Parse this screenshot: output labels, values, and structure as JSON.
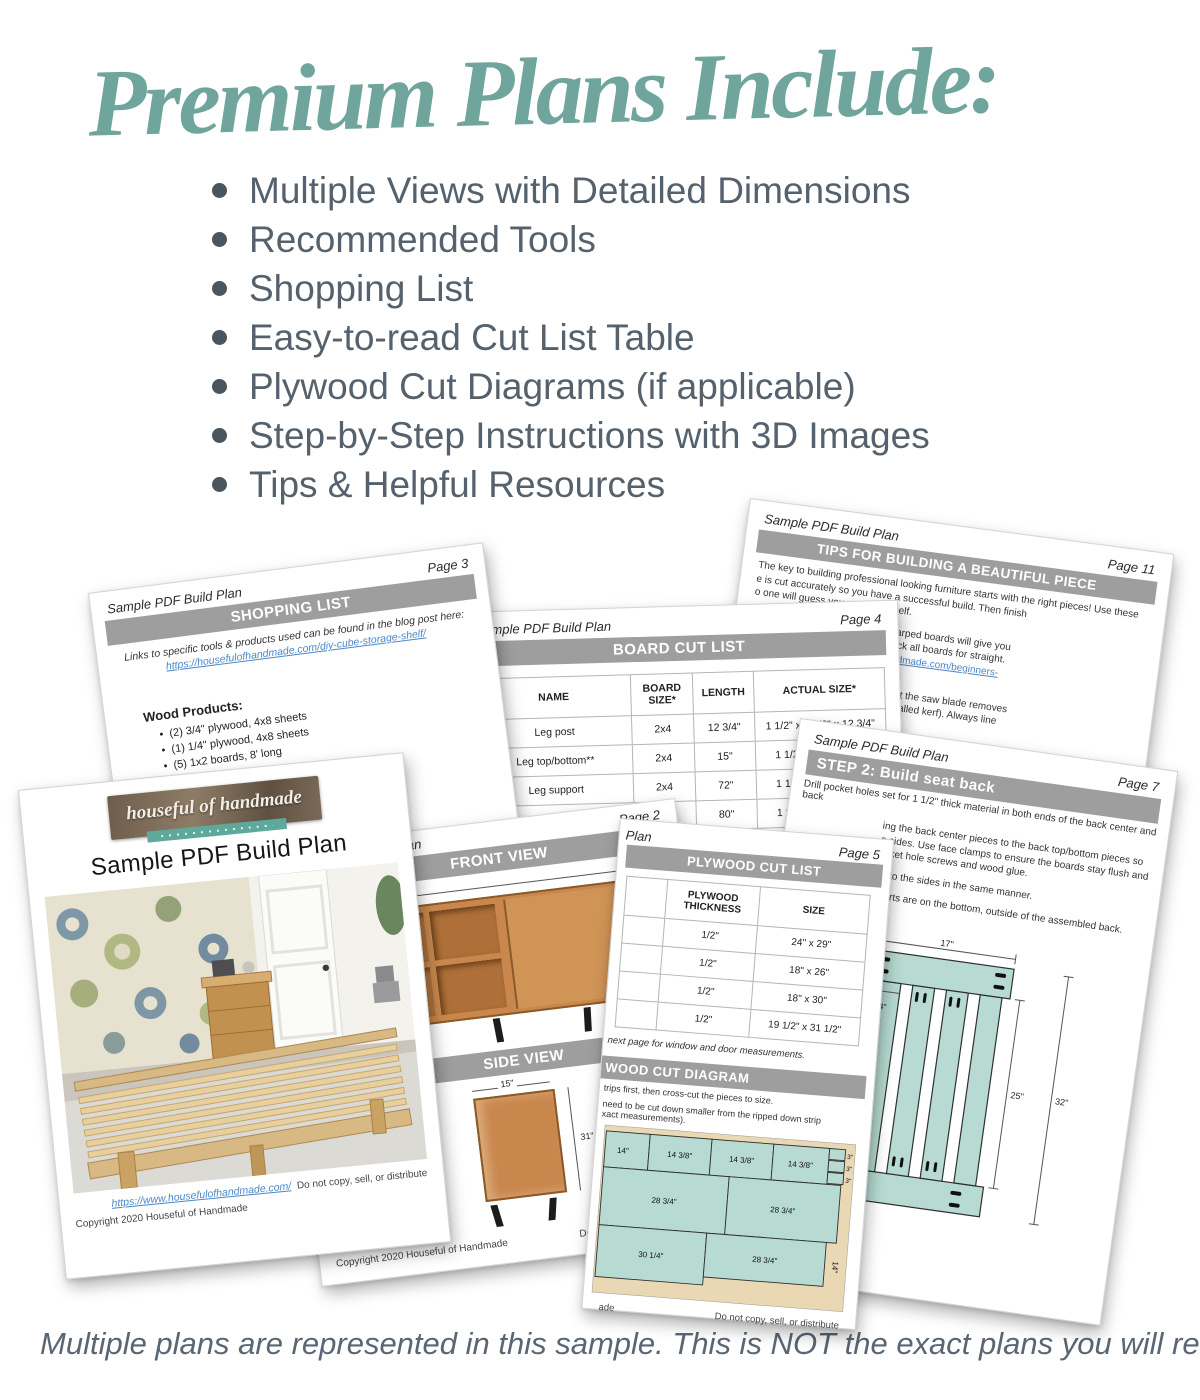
{
  "headline": {
    "title": "Premium Plans Include:"
  },
  "bullets": [
    "Multiple Views with Detailed Dimensions",
    "Recommended Tools",
    "Shopping List",
    "Easy-to-read Cut List Table",
    "Plywood Cut Diagrams (if applicable)",
    "Step-by-Step Instructions with 3D Images",
    "Tips & Helpful Resources"
  ],
  "footer_note": "Multiple plans are represented in this sample. This is NOT the exact plans you will recieve.",
  "colors": {
    "accent_teal": "#6FA59D",
    "banner_gray": "#9E9E9E",
    "link_blue": "#4A87C7",
    "teal_piece": "#B7DBD2",
    "plywood_tan": "#EAD8B4"
  },
  "pages": {
    "cover": {
      "logo_text": "houseful of handmade",
      "doc_title": "Sample PDF Build Plan",
      "footer_link": "https://www.housefulofhandmade.com/",
      "footer_right": "Do not copy, sell, or distribute",
      "footer_copyright": "Copyright 2020 Houseful of Handmade"
    },
    "shopping": {
      "header": "Sample PDF Build Plan",
      "page_label": "Page 3",
      "banner": "SHOPPING LIST",
      "intro": "Links to specific tools & products used can be found in the blog post here:",
      "link": "https://housefulofhandmade.com/diy-cube-storage-shelf/",
      "section_heading": "Wood Products:",
      "items": [
        "(2) 3/4\" plywood, 4x8 sheets",
        "(1) 1/4\" plywood, 4x8 sheets",
        "(5) 1x2 boards, 8' long"
      ]
    },
    "board_cut": {
      "header": "Sample PDF Build Plan",
      "page_label": "Page 4",
      "banner": "BOARD CUT LIST",
      "columns": [
        "NAME",
        "BOARD SIZE*",
        "LENGTH",
        "ACTUAL SIZE*"
      ],
      "rows": [
        [
          "Leg post",
          "2x4",
          "12 3/4\"",
          "1 1/2\" x 3 1/2\" x 12 3/4\""
        ],
        [
          "Leg top/bottom**",
          "2x4",
          "15\"",
          "1 1/2\" x 3 1/2\" x 15\""
        ],
        [
          "Leg support",
          "2x4",
          "72\"",
          "1 1/2\" x 3 1/2\" x 72\""
        ],
        [
          "Seat slats",
          "2x6",
          "80\"",
          "1 1/2\" x 5 1/2\" x 80\""
        ],
        [
          "",
          "1x4",
          "3 1/2\"",
          "3/4\" x 3 1/2\" x 3 1/2\""
        ]
      ],
      "footnote_fragment": "dimensional"
    },
    "views": {
      "header": "Sample PDF Build Plan",
      "page_label": "Page 2",
      "front_banner": "FRONT VIEW",
      "side_banner": "SIDE VIEW",
      "front_width_dim": "45 1/4\"",
      "front_height_dim": "31\"",
      "cubby_dim_a": "1/4\"",
      "cubby_dim_b": "4\"",
      "side_width_dim": "15\"",
      "side_height_dim": "31\"",
      "footer_copyright": "Copyright 2020 Houseful of Handmade",
      "footer_right": "Do not copy, sell, or distribute"
    },
    "plywood": {
      "header_fragment": "Plan",
      "page_label": "Page 5",
      "banner": "PLYWOOD CUT LIST",
      "columns": [
        "",
        "PLYWOOD THICKNESS",
        "SIZE"
      ],
      "rows": [
        [
          "",
          "1/2\"",
          "24\" x 29\""
        ],
        [
          "",
          "1/2\"",
          "18\" x 26\""
        ],
        [
          "",
          "1/2\"",
          "18\" x 30\""
        ],
        [
          "",
          "1/2\"",
          "19 1/2\" x 31 1/2\""
        ]
      ],
      "note": "next page for window and door measurements.",
      "diagram_banner": "WOOD CUT DIAGRAM",
      "diagram_lines": [
        "trips first, then cross-cut the pieces to size.",
        "need to be cut down smaller from the ripped down strip",
        "xact measurements)."
      ],
      "diagram_labels": {
        "r1a": "14\"",
        "r1b": "14 3/8\"",
        "r1c": "14 3/8\"",
        "r1d": "14 3/8\"",
        "s1": "3\"",
        "s2": "3\"",
        "s3": "3\"",
        "r2a": "28 3/4\"",
        "r2b": "28 3/4\"",
        "r3a": "30 1/4\"",
        "r3b": "28 3/4\"",
        "r3h": "14\""
      },
      "footer_left_fragment": "ade",
      "footer_right": "Do not copy, sell, or distribute"
    },
    "step2": {
      "header": "Sample PDF Build Plan",
      "page_label": "Page 7",
      "banner": "STEP 2: Build seat back",
      "intro": "Drill pocket holes set for 1 1/2\" thick material in both ends of the back center and back",
      "paragraphs": [
        "ing the back center pieces to the back top/bottom pieces so",
        "e sides. Use face clamps to ensure the boards stay flush and",
        "ocket hole screws and wood glue.",
        "es to the sides in the same manner.",
        "nserts are on the bottom, outside of the assembled back."
      ],
      "dims": {
        "top": "17\"",
        "left": "4 1/4\"",
        "mid": "25\"",
        "right": "32\""
      }
    },
    "tips": {
      "header": "Sample PDF Build Plan",
      "page_label": "Page 11",
      "banner": "TIPS FOR BUILDING A BEAUTIFUL PIECE",
      "lines": [
        {
          "b": "",
          "t": "The key to building professional looking furniture starts with the right pieces! Use these"
        },
        {
          "b": "",
          "t": "e is cut accurately so you have a successful build. Then finish"
        },
        {
          "b": "",
          "t": "o one will guess you made yourself."
        },
        {
          "b": "wood is straight.",
          "t": " Twisted and warped boards will give you"
        },
        {
          "b": "",
          "t": "d furniture. Take extra time to check all boards for straight."
        },
        {
          "b": "",
          "t": "umber here: ",
          "link": "https://housefulofhandmade.com/beginners-"
        },
        {
          "b": "",
          "t": "",
          "link": "mber/"
        },
        {
          "b": "s are cut accurately.",
          "t": " Be aware that the saw blade removes"
        },
        {
          "b": "",
          "t": "ood from the board when you cut (called kerf). Always line"
        },
        {
          "b": "",
          "t": "e up with the line, not the center."
        },
        {
          "b": "up your blades so you get straight cuts.",
          "t": " This will ensure"
        },
        {
          "b": "",
          "t": "uts. Make sure your blades are square to the fence and cut"
        },
        {
          "b": "",
          "t": "ees."
        },
        {
          "b": "re cutting.",
          "t": " Square off the raw edge of your plywood or"
        },
        {
          "b": "",
          "t": "from the factory perfectly square which"
        }
      ]
    }
  }
}
